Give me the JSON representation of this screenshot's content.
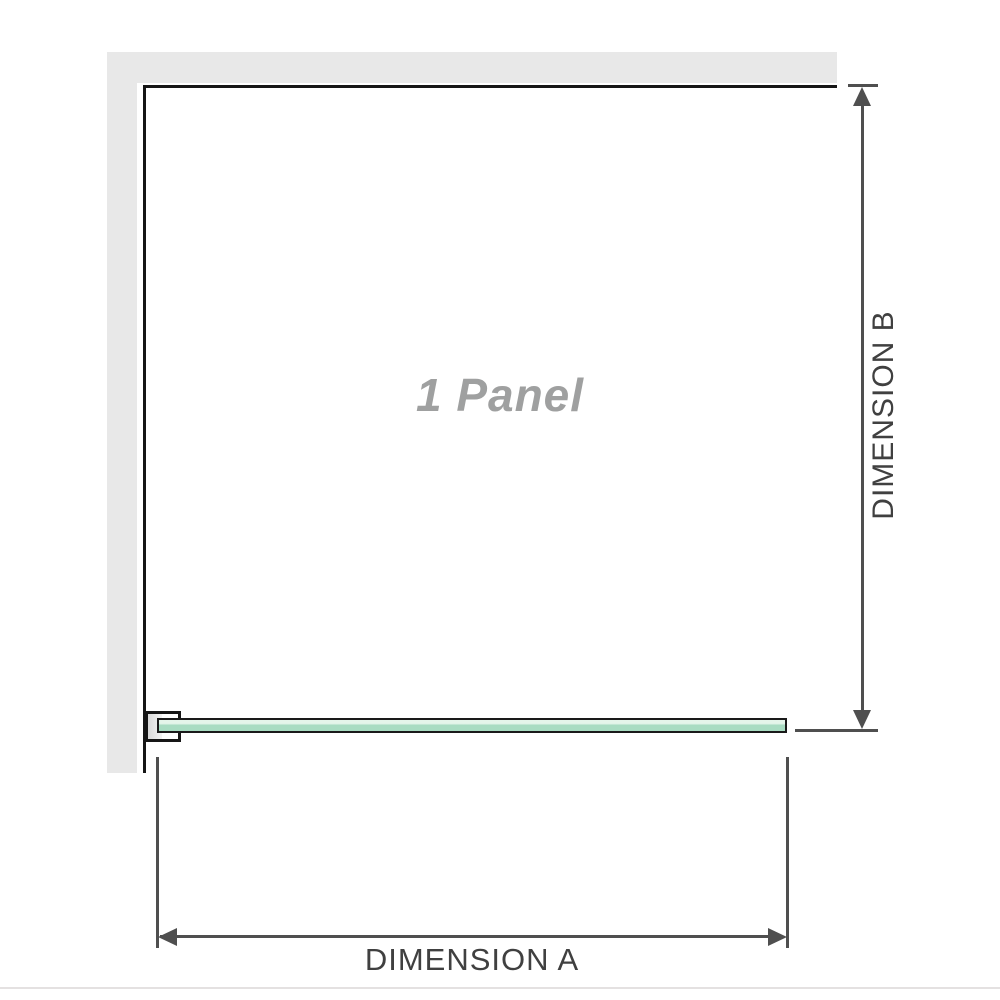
{
  "diagram": {
    "panel_label": "1 Panel",
    "dimension_a_label": "DIMENSION A",
    "dimension_b_label": "DIMENSION B"
  },
  "colors": {
    "background": "#ffffff",
    "wall": "#e8e8e8",
    "frame-line": "#161616",
    "dim-line": "#4f4f4f",
    "dim-text": "#404040",
    "panel-text": "#9fa0a0",
    "glass-border": "#1a1a1a",
    "glass-light": "#e4f5ea",
    "glass-main": "#a8dcc2",
    "bracket-fill": "#d9d9d9",
    "footer-line": "#e4e1e1"
  }
}
